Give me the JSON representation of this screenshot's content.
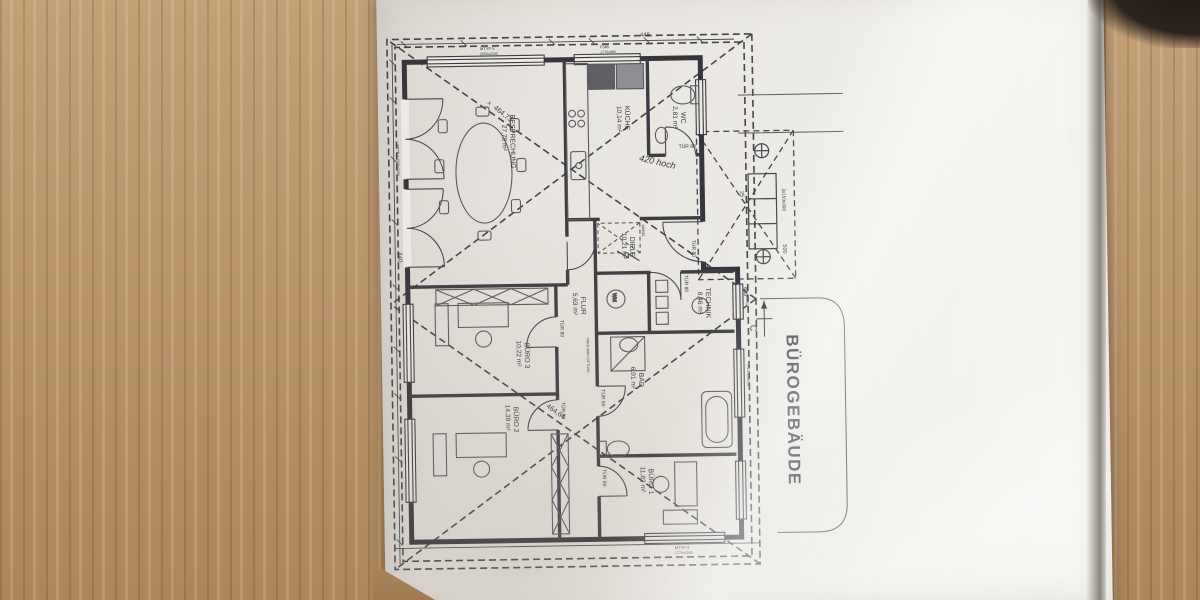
{
  "photo": {
    "description": "Photograph of an architectural floor plan on a wooden desk, sheet rotated 90 degrees",
    "paper_tone": "#ebe9e4",
    "wood_tone": "#b5906a",
    "line_color": "#3c3c42"
  },
  "plan": {
    "title": "BÜROGEBÄUDE",
    "section_marker": "C",
    "rooms": [
      {
        "name": "BESPRECHUNG",
        "area": "27,79 m²"
      },
      {
        "name": "KÜCHE",
        "area": "10,14 m²"
      },
      {
        "name": "WC",
        "area": "2,81 m²"
      },
      {
        "name": "DIELE",
        "area": "10,21 m²"
      },
      {
        "name": "FLUR",
        "area": "5,63 m²"
      },
      {
        "name": "TECHNIK",
        "area": "8,46 m²"
      },
      {
        "name": "BAD",
        "area": "6,91 m²"
      },
      {
        "name": "BÜRO 3",
        "area": "10,22 m²"
      },
      {
        "name": "BÜRO 2",
        "area": "14,39 m²"
      },
      {
        "name": "BÜRO 1",
        "area": "11,82 m²"
      }
    ],
    "door_label": "TÜR 80",
    "dimensions": {
      "d440": "440",
      "d448": "448",
      "d500": "500",
      "d25": "25",
      "steps": "3x150x300",
      "diag_left": "464,73",
      "diag_left_mark": "x",
      "diag_right": "464,64"
    },
    "window_labels": {
      "mtyp5": "MTYP 5",
      "mtyp5_size": "2565x2265",
      "f365": "F365",
      "f365_size": "1770x885",
      "mtyp2": "MTYP 2",
      "mtyp2_size": "1770x2265",
      "mtyp4": "MTYP 4 2565x2265",
      "f14a": "F14 120x50",
      "f14b": "F14 120x50"
    },
    "symbols": {
      "washing_machine": "WM",
      "wardrobe": "MÖBEL",
      "vent_note": "VOKO 4980 LÜFTUNG"
    },
    "handwriting": "420 hoch"
  }
}
